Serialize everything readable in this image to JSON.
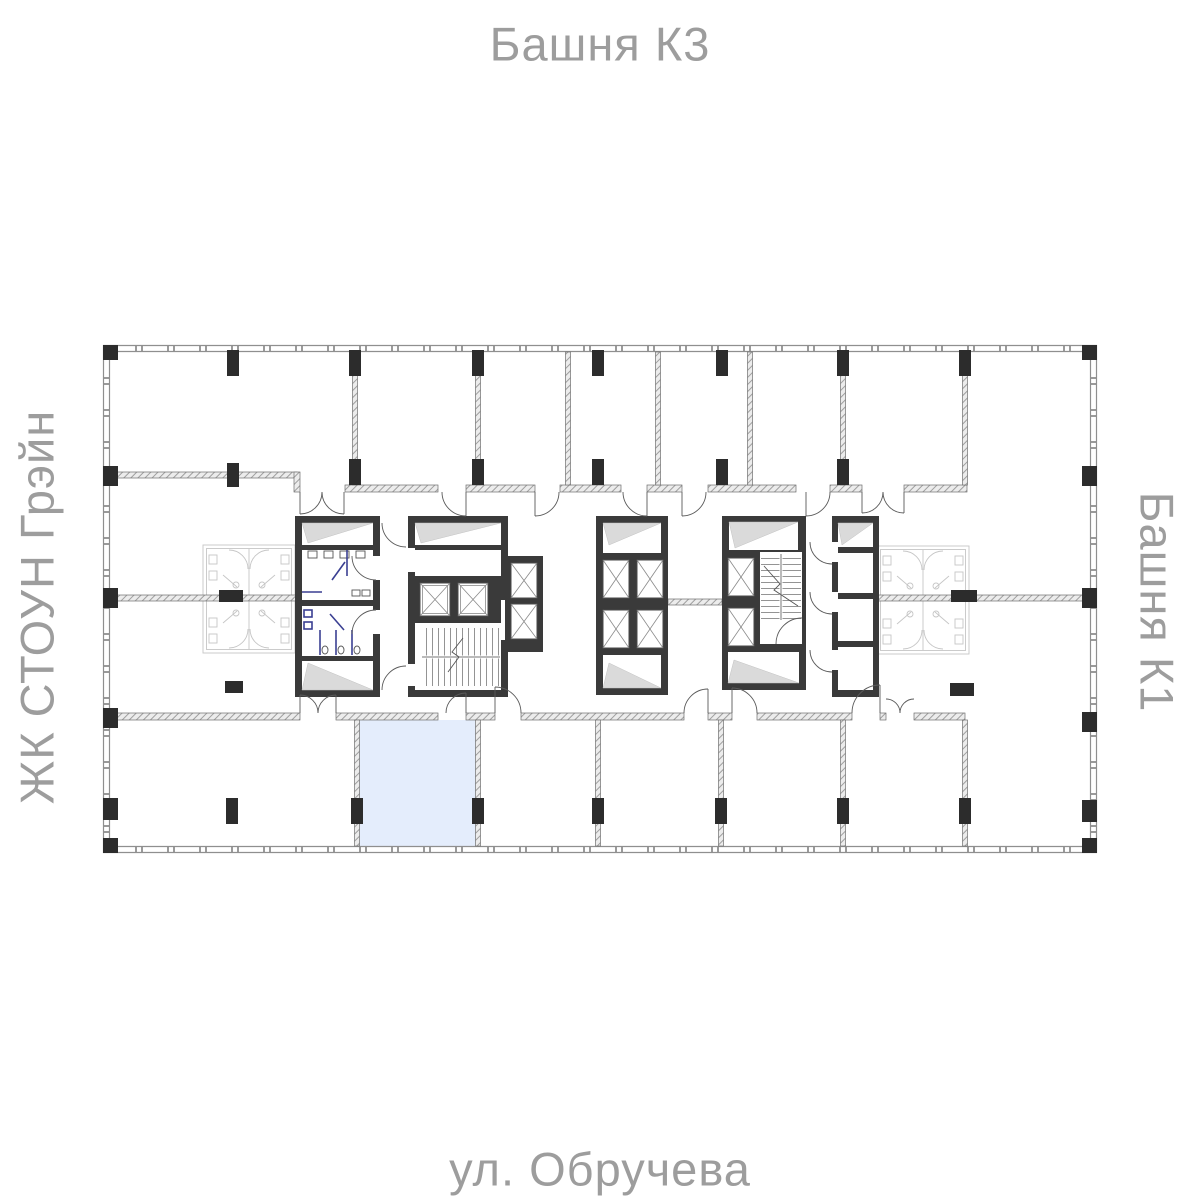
{
  "labels": {
    "top": "Башня К3",
    "right": "Башня К1",
    "bottom": "ул. Обручева",
    "left": "ЖК СТОУН Грэйн"
  },
  "label_color": "#9D9D9D",
  "plan": {
    "highlighted_unit": {
      "fill": "#E4EDFC"
    },
    "colors": {
      "outer_wall": "#8F8F8F",
      "partition_fill": "#ECECEC",
      "core_wall": "#3A3A3A",
      "column": "#2C2C2C",
      "sanitary_fixture": "#3A3F92",
      "ghost_fixture": "#C6C6C6"
    },
    "icons": {
      "elevator-shaft-icon": "box-with-x",
      "stair-icon": "tread-lines",
      "door-icon": "quarter-arc",
      "column-icon": "filled-rect",
      "wc-fixture-icon": "small-rect"
    }
  }
}
